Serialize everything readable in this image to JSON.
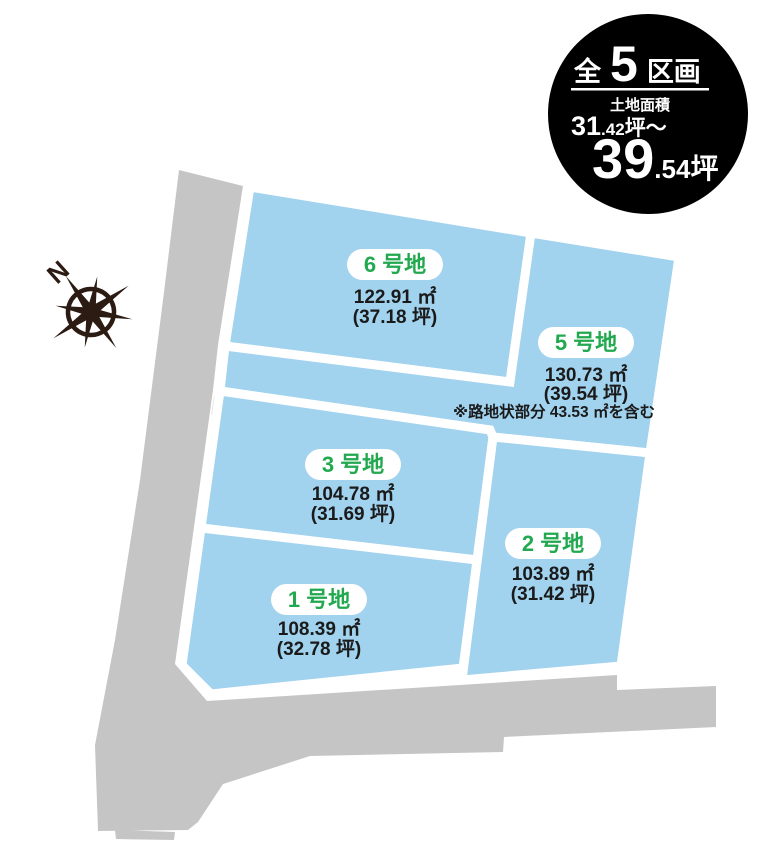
{
  "badge": {
    "total_prefix": "全",
    "total_count": "5",
    "total_suffix": "区画",
    "area_label": "土地面積",
    "min_value": "31",
    "min_decimal": ".42",
    "min_unit": "坪〜",
    "max_value": "39",
    "max_decimal": ".54",
    "max_unit": "坪"
  },
  "compass": {
    "north_label": "N"
  },
  "plots": [
    {
      "id": "6",
      "label": "6 号地",
      "area_sqm": "122.91 ㎡",
      "area_tsubo": "(37.18 坪)"
    },
    {
      "id": "5",
      "label": "5 号地",
      "area_sqm": "130.73 ㎡",
      "area_tsubo": "(39.54 坪)",
      "note": "※路地状部分 43.53 ㎡を含む"
    },
    {
      "id": "3",
      "label": "3 号地",
      "area_sqm": "104.78 ㎡",
      "area_tsubo": "(31.69 坪)"
    },
    {
      "id": "2",
      "label": "2 号地",
      "area_sqm": "103.89 ㎡",
      "area_tsubo": "(31.42 坪)"
    },
    {
      "id": "1",
      "label": "1 号地",
      "area_sqm": "108.39 ㎡",
      "area_tsubo": "(32.78 坪)"
    }
  ],
  "colors": {
    "plot_fill": "#a1d2ee",
    "road_fill": "#c5c5c5",
    "notch_fill": "#e8e8e8",
    "label_green": "#22a94f",
    "text_dark": "#1a1a1a",
    "badge_bg": "#000000",
    "compass_dark": "#2b1b12"
  }
}
